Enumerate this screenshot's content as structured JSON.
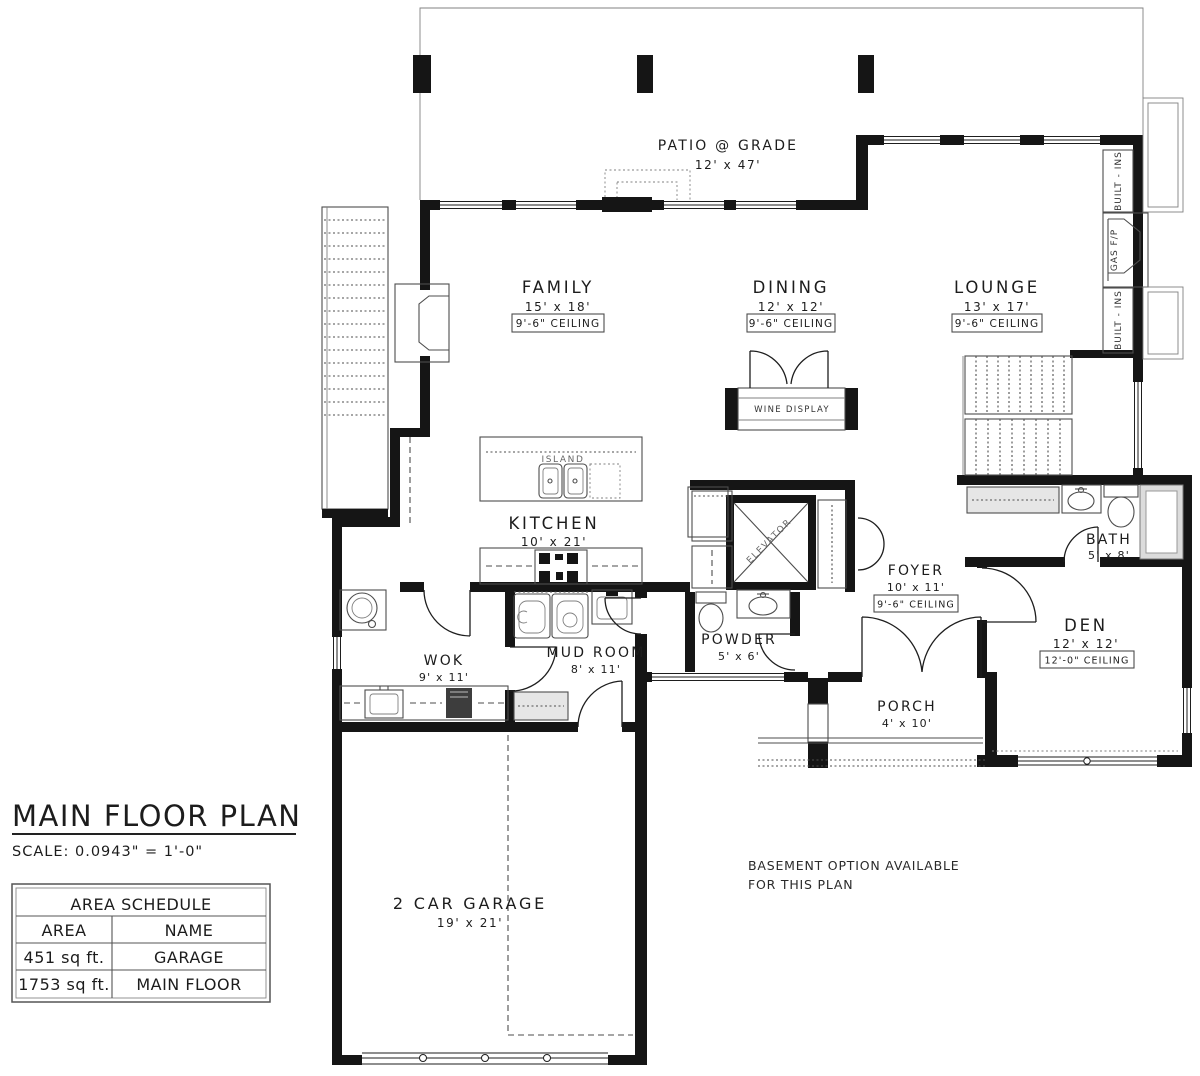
{
  "title_block": {
    "title": "MAIN FLOOR PLAN",
    "scale": "SCALE: 0.0943\" = 1'-0\""
  },
  "notes": {
    "line1": "BASEMENT OPTION AVAILABLE",
    "line2": "FOR THIS PLAN"
  },
  "area_schedule": {
    "title": "AREA SCHEDULE",
    "headers": [
      "AREA",
      "NAME"
    ],
    "rows": [
      {
        "area": "451 sq ft.",
        "name": "GARAGE"
      },
      {
        "area": "1753 sq ft.",
        "name": "MAIN FLOOR"
      }
    ]
  },
  "rooms": {
    "patio": {
      "name": "PATIO @ GRADE",
      "dims": "12' x 47'"
    },
    "family": {
      "name": "FAMILY",
      "dims": "15' x 18'",
      "ceiling": "9'-6\" CEILING"
    },
    "dining": {
      "name": "DINING",
      "dims": "12' x 12'",
      "ceiling": "9'-6\" CEILING"
    },
    "lounge": {
      "name": "LOUNGE",
      "dims": "13' x 17'",
      "ceiling": "9'-6\" CEILING"
    },
    "kitchen": {
      "name": "KITCHEN",
      "dims": "10' x 21'"
    },
    "foyer": {
      "name": "FOYER",
      "dims": "10' x 11'",
      "ceiling": "9'-6\" CEILING"
    },
    "bath": {
      "name": "BATH",
      "dims": "5' x 8'"
    },
    "den": {
      "name": "DEN",
      "dims": "12' x 12'",
      "ceiling": "12'-0\" CEILING"
    },
    "powder": {
      "name": "POWDER",
      "dims": "5' x 6'"
    },
    "wok": {
      "name": "WOK",
      "dims": "9' x 11'"
    },
    "mudroom": {
      "name": "MUD ROOM",
      "dims": "8' x 11'"
    },
    "porch": {
      "name": "PORCH",
      "dims": "4' x 10'"
    },
    "garage": {
      "name": "2 CAR GARAGE",
      "dims": "19' x 21'"
    }
  },
  "features": {
    "island": "ISLAND",
    "wine_display": "WINE DISPLAY",
    "elevator": "ELEVATOR",
    "built_ins_upper": "BUILT - INS",
    "gas_fireplace": "GAS F/P",
    "built_ins_lower": "BUILT - INS"
  }
}
